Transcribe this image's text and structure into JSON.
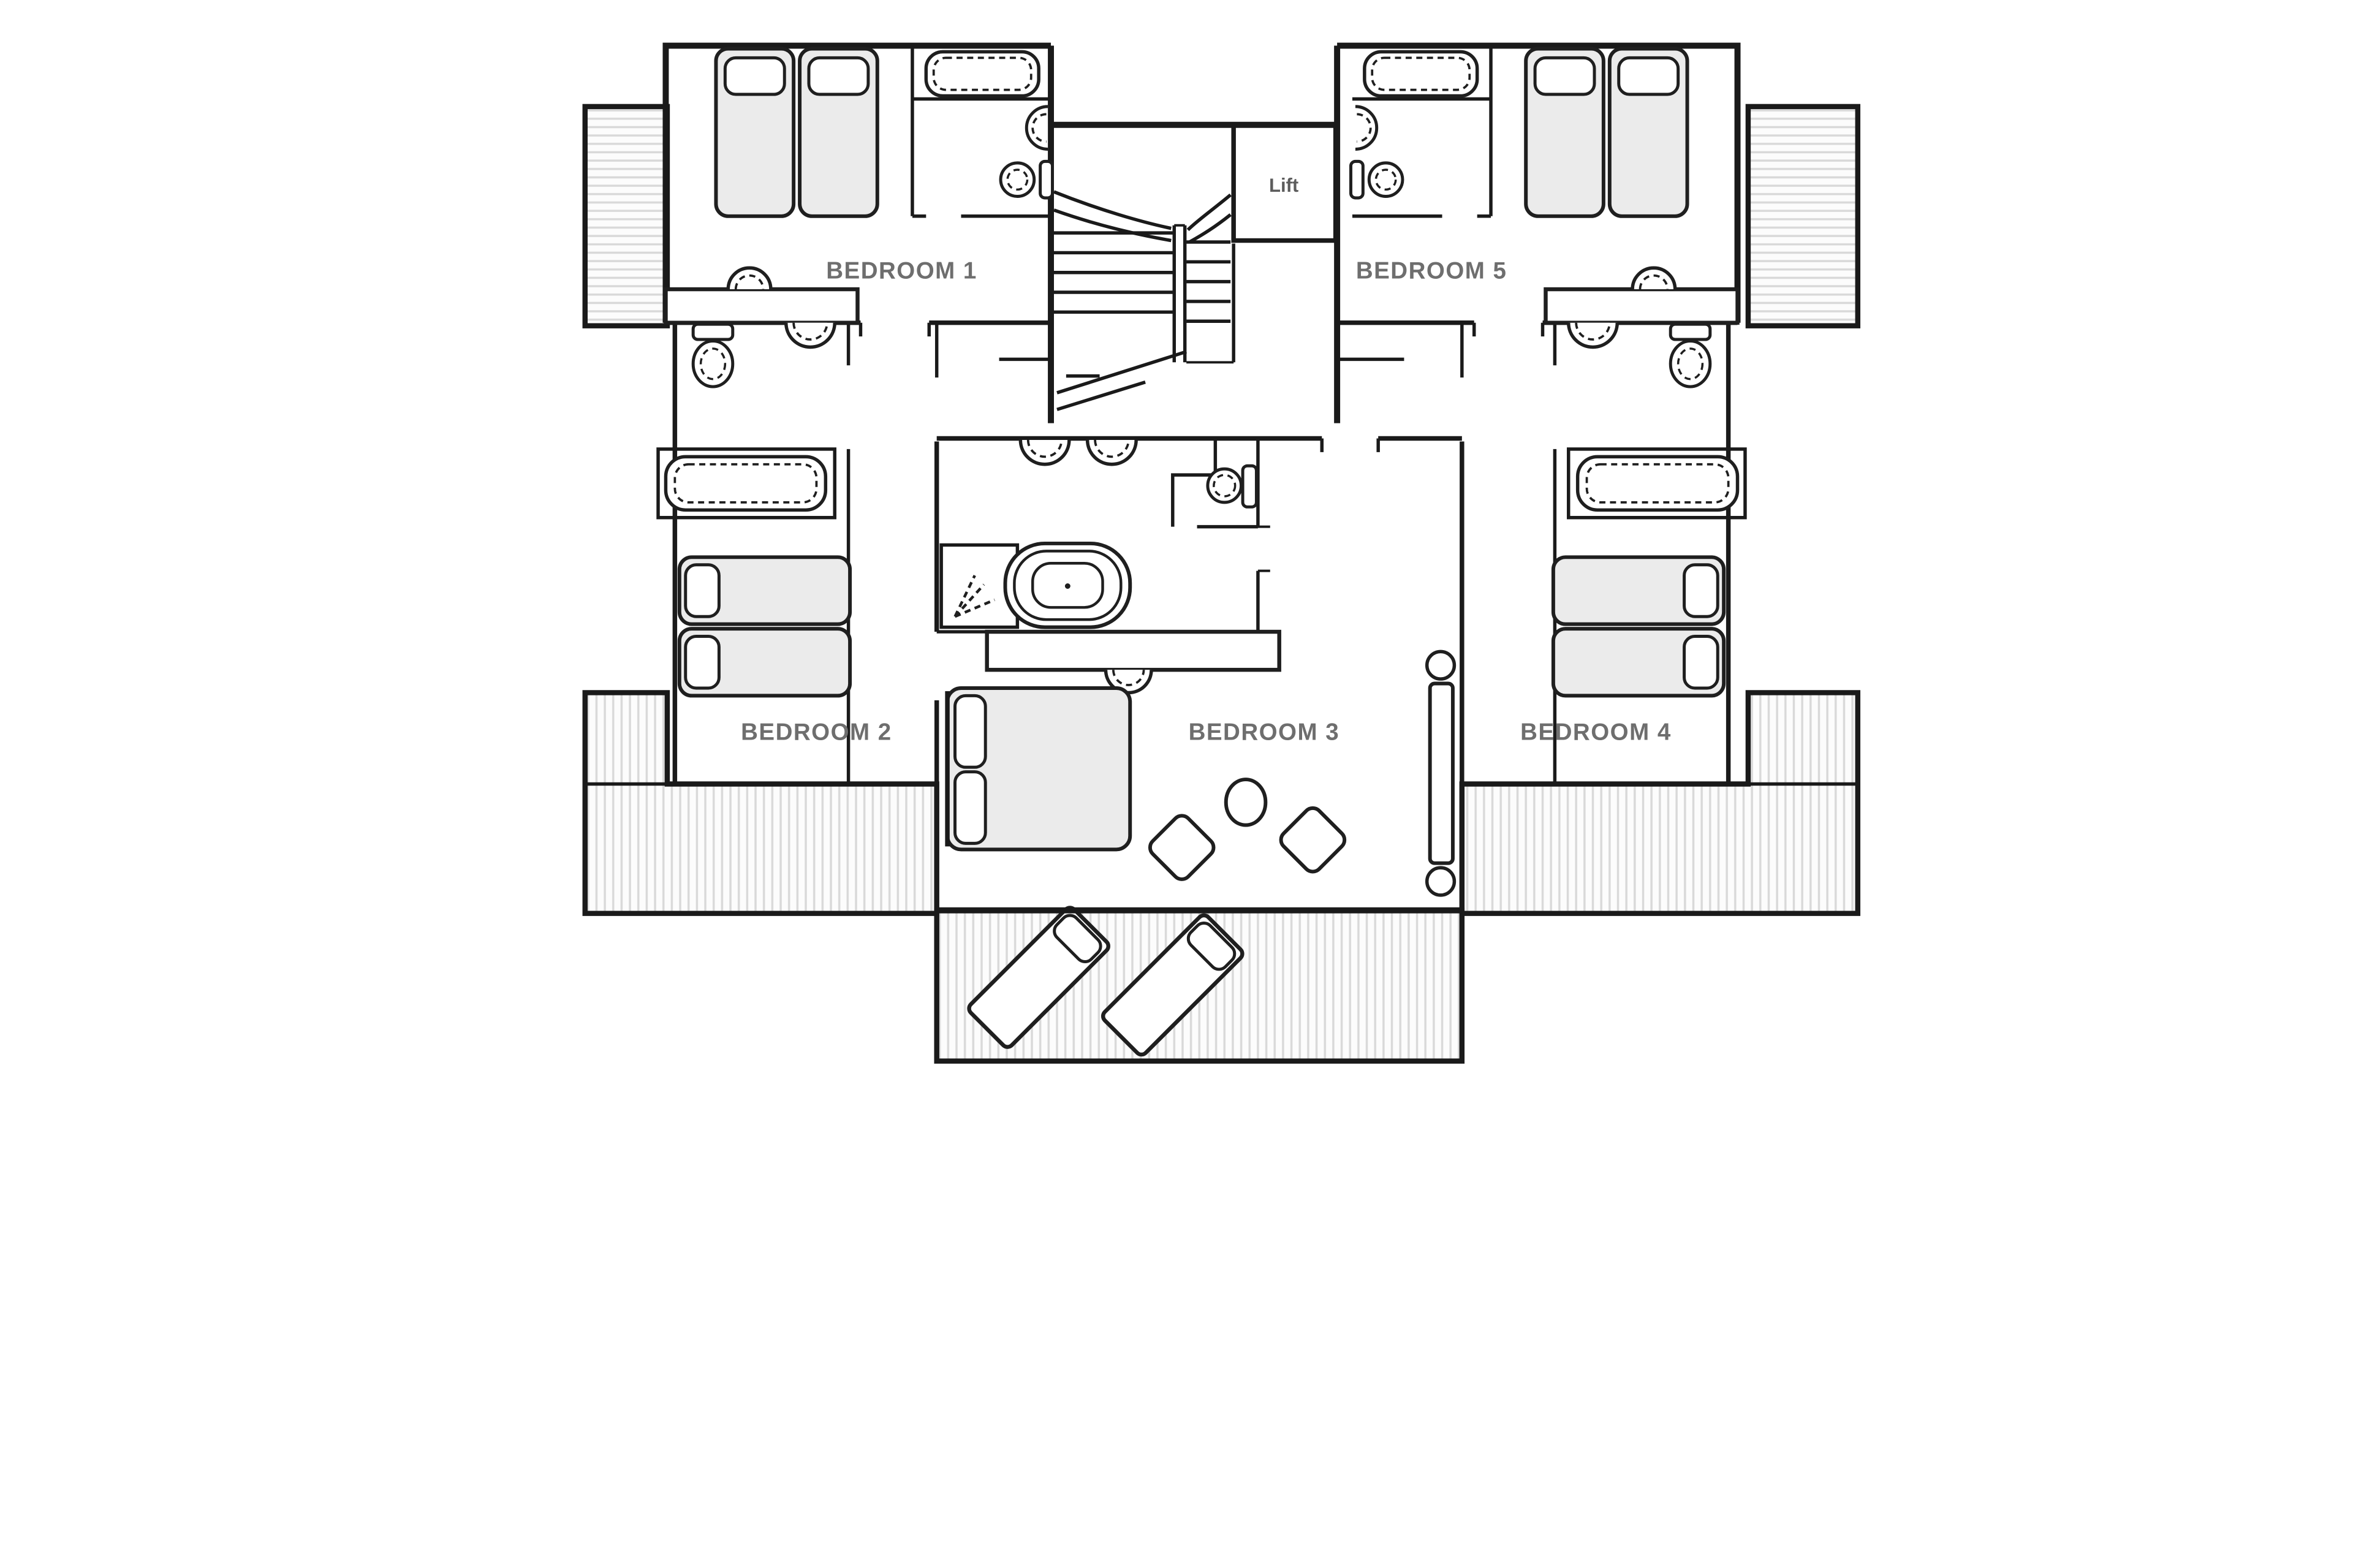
{
  "plan": {
    "type": "floor-plan",
    "floor_description": "Upper floor with five bedrooms, central stair and lift, shared bathroom, balconies and terraces",
    "rooms": [
      {
        "id": "bedroom-1",
        "label": "BEDROOM 1",
        "furniture": [
          "twin-beds",
          "bathtub",
          "toilet",
          "washbasin",
          "vanity-counter"
        ]
      },
      {
        "id": "bedroom-2",
        "label": "BEDROOM 2",
        "furniture": [
          "twin-beds",
          "bathtub",
          "toilet",
          "washbasin"
        ]
      },
      {
        "id": "bedroom-3",
        "label": "BEDROOM 3",
        "furniture": [
          "double-bed",
          "two-chairs",
          "round-table",
          "sliding-door"
        ]
      },
      {
        "id": "bedroom-4",
        "label": "BEDROOM 4",
        "furniture": [
          "twin-beds",
          "bathtub",
          "toilet",
          "washbasin"
        ]
      },
      {
        "id": "bedroom-5",
        "label": "BEDROOM 5",
        "furniture": [
          "twin-beds",
          "bathtub",
          "toilet",
          "washbasin",
          "vanity-counter"
        ]
      }
    ],
    "lift": {
      "label": "Lift"
    },
    "shared_bathroom": {
      "fixtures": [
        "freestanding-bathtub",
        "shower",
        "wc-cubicle",
        "twin-basins",
        "vanity-counter"
      ]
    },
    "outdoor": {
      "areas": [
        "left-balcony",
        "right-balcony",
        "left-terrace",
        "right-terrace",
        "central-terrace"
      ],
      "loungers": 2
    },
    "colors": {
      "wall": "#1a1a1a",
      "room_label": "#6e6e6e",
      "lift_label": "#5c5c5c",
      "bed_fill": "#ebebeb",
      "hatch_line": "#d9d9d9",
      "background": "#ffffff"
    }
  }
}
